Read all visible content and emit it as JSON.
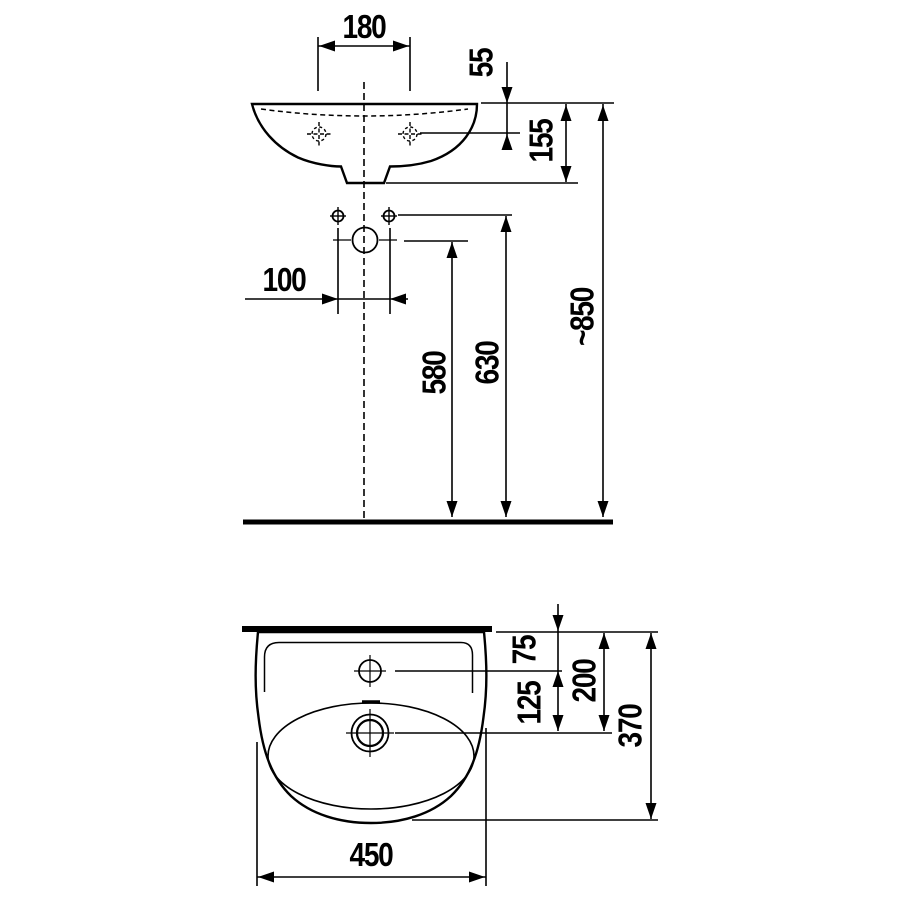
{
  "drawing": {
    "kind": "washbasin installation dimension drawing",
    "units_note": "mm",
    "colors": {
      "line": "#000000",
      "background": "#ffffff"
    },
    "views": [
      {
        "name": "front-elevation",
        "dimension_labels": [
          "180",
          "55",
          "155",
          "100",
          "580",
          "630",
          "~850"
        ]
      },
      {
        "name": "plan-view",
        "dimension_labels": [
          "75",
          "125",
          "200",
          "370",
          "450"
        ]
      }
    ]
  },
  "front_view": {
    "d180": "180",
    "d55": "55",
    "d155": "155",
    "d100": "100",
    "d580": "580",
    "d630": "630",
    "d850": "~850"
  },
  "plan_view": {
    "d75": "75",
    "d125": "125",
    "d200": "200",
    "d370": "370",
    "d450": "450"
  }
}
